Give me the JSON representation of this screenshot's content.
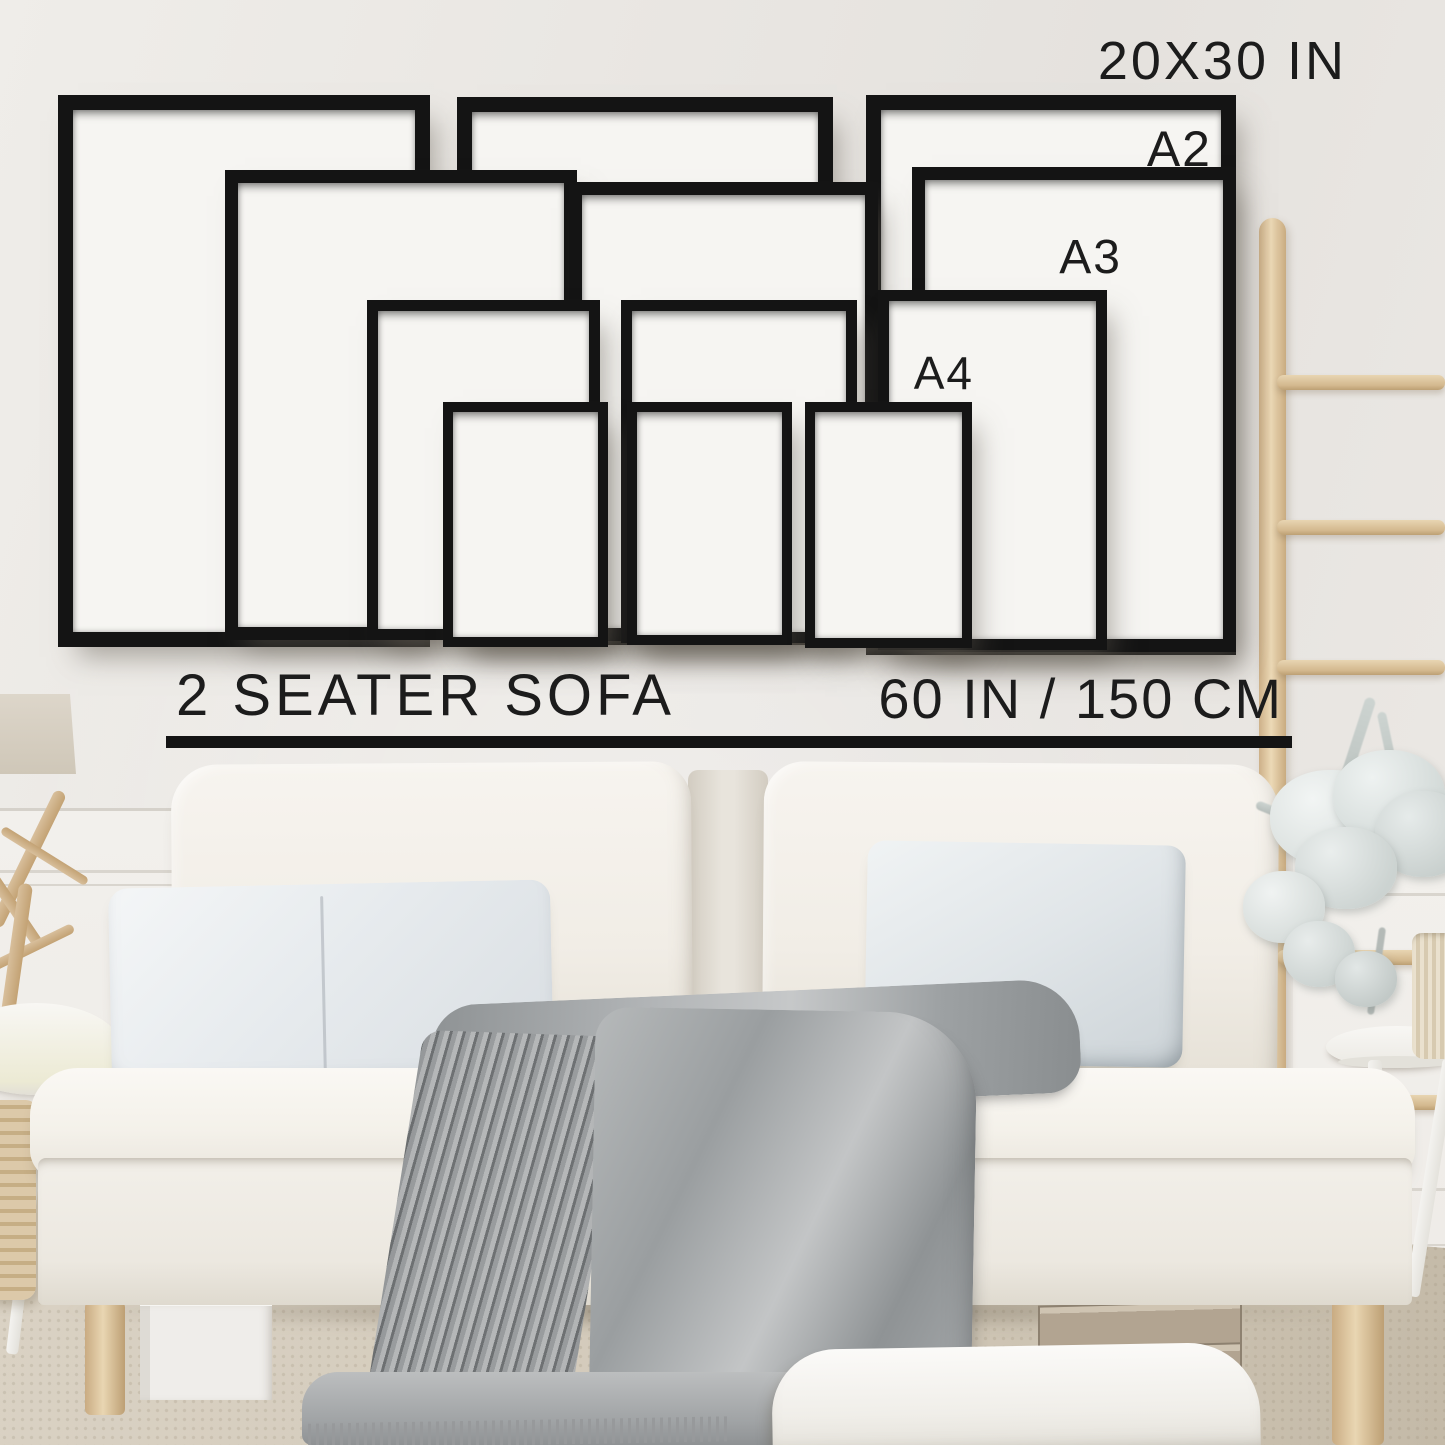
{
  "image": {
    "kind": "frame-size-guide-product-mockup",
    "setting": "living room wall above a two seater sofa"
  },
  "size_guide": {
    "largest_size_label": "20X30 IN",
    "a2_label": "A2",
    "a3_label": "A3",
    "a4_label": "A4",
    "sizes_shown": [
      "20X30 IN",
      "A2",
      "A3",
      "A4"
    ],
    "frames_per_size": 3,
    "frame_color": "#141414",
    "frame_mat_color": "#f6f5f2",
    "label_color": "#1c1c1c"
  },
  "scale_reference": {
    "sofa_label": "2 SEATER SOFA",
    "sofa_width_label": "60 IN / 150 CM",
    "measure_line_color": "#141414"
  },
  "room": {
    "wall_color": "#e8e5e1",
    "sofa_color": "#f5f2ec",
    "pillow_color": "#e3e7ea",
    "blanket_color": "#a4a7a9",
    "rug_color": "#d6cdbe",
    "wood_color": "#dfc6a0"
  }
}
